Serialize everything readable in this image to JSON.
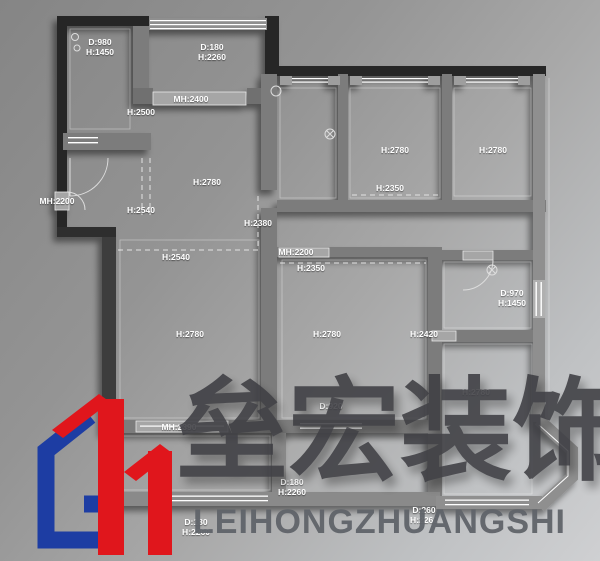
{
  "watermark": {
    "company_cn": "垒宏装饰",
    "company_en": "LEIHONGZHUANGSHI"
  },
  "logo": {
    "blue": "#1d3da3",
    "red": "#e0161c"
  },
  "colors": {
    "background_dark": "#858585",
    "background_light": "#cfd0d2",
    "wall_dark": "#262626",
    "wall_gray": "#7b7b7b",
    "label_text": "#ffffff",
    "watermark_cn": "#3e3e43",
    "watermark_en": "#60646a"
  },
  "floorplan": {
    "labels": [
      {
        "x": 100,
        "y": 37,
        "lines": [
          "D:980",
          "H:1450"
        ]
      },
      {
        "x": 212,
        "y": 42,
        "lines": [
          "D:180",
          "H:2260"
        ]
      },
      {
        "x": 191,
        "y": 94,
        "lines": [
          "MH:2400"
        ]
      },
      {
        "x": 141,
        "y": 107,
        "lines": [
          "H:2500"
        ]
      },
      {
        "x": 395,
        "y": 145,
        "lines": [
          "H:2780"
        ]
      },
      {
        "x": 493,
        "y": 145,
        "lines": [
          "H:2780"
        ]
      },
      {
        "x": 390,
        "y": 183,
        "lines": [
          "H:2350"
        ]
      },
      {
        "x": 57,
        "y": 196,
        "lines": [
          "MH:2200"
        ]
      },
      {
        "x": 207,
        "y": 177,
        "lines": [
          "H:2780"
        ]
      },
      {
        "x": 141,
        "y": 205,
        "lines": [
          "H:2540"
        ]
      },
      {
        "x": 258,
        "y": 218,
        "lines": [
          "H:2380"
        ]
      },
      {
        "x": 176,
        "y": 252,
        "lines": [
          "H:2540"
        ]
      },
      {
        "x": 296,
        "y": 247,
        "lines": [
          "MH:2200"
        ]
      },
      {
        "x": 311,
        "y": 263,
        "lines": [
          "H:2350"
        ]
      },
      {
        "x": 190,
        "y": 329,
        "lines": [
          "H:2780"
        ]
      },
      {
        "x": 327,
        "y": 329,
        "lines": [
          "H:2780"
        ]
      },
      {
        "x": 512,
        "y": 288,
        "lines": [
          "D:970",
          "H:1450"
        ]
      },
      {
        "x": 424,
        "y": 329,
        "lines": [
          "H:2420"
        ]
      },
      {
        "x": 476,
        "y": 387,
        "lines": [
          "H:2780"
        ]
      },
      {
        "x": 331,
        "y": 401,
        "lines": [
          "D:920"
        ]
      },
      {
        "x": 179,
        "y": 422,
        "lines": [
          "MH:2390"
        ]
      },
      {
        "x": 292,
        "y": 477,
        "lines": [
          "D:180",
          "H:2260"
        ]
      },
      {
        "x": 196,
        "y": 517,
        "lines": [
          "D:180",
          "H:2260"
        ]
      },
      {
        "x": 424,
        "y": 505,
        "lines": [
          "D:260",
          "H:2260"
        ]
      }
    ]
  }
}
